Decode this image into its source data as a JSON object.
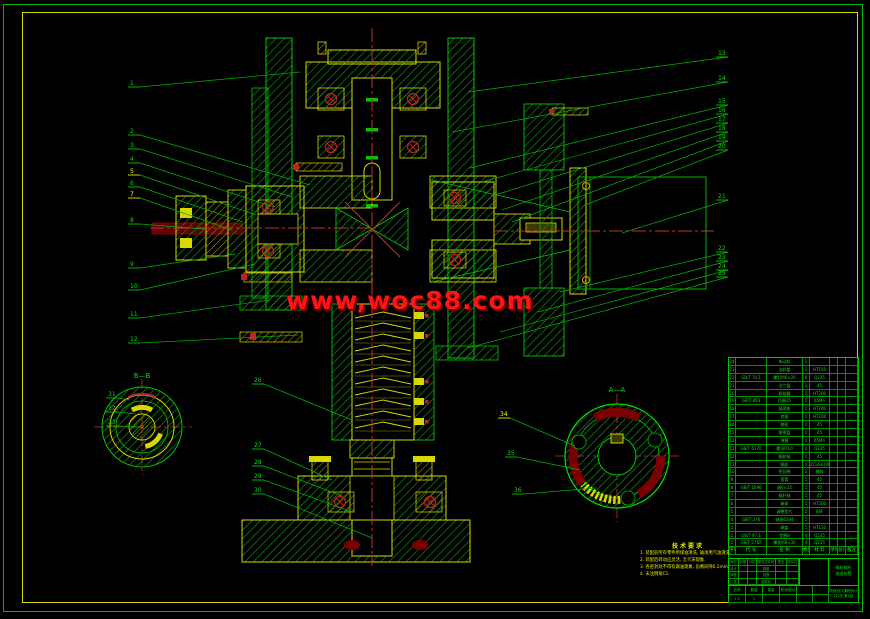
{
  "colors": {
    "green": "#00C800",
    "bright_green": "#00FF00",
    "yellow": "#D8D800",
    "red": "#FF1414",
    "dark_red": "#8B0000",
    "centerline_red": "#C23030",
    "hatch_green": "#128A12"
  },
  "watermark": {
    "text": "www,woc88.com"
  },
  "views": {
    "left_label": "B—B",
    "right_label": "A—A"
  },
  "notes": {
    "title": "技术要求",
    "lines": [
      "1. 装配前所有零件用煤油清洗, 轴承用汽油清洗.",
      "2. 装配后转动应灵活, 无卡滞现象.",
      "3. 各密封处不得有漏油现象, 齿侧间隙0.2mm.",
      "4. 未注倒角C1."
    ]
  },
  "callouts": [
    {
      "n": "1",
      "c": "g",
      "lx": 128,
      "ly": 85,
      "tx": 300,
      "ty": 72
    },
    {
      "n": "2",
      "c": "g",
      "lx": 128,
      "ly": 133,
      "tx": 310,
      "ty": 185
    },
    {
      "n": "3",
      "c": "g",
      "lx": 128,
      "ly": 147,
      "tx": 292,
      "ty": 197
    },
    {
      "n": "4",
      "c": "g",
      "lx": 128,
      "ly": 161,
      "tx": 274,
      "ty": 207
    },
    {
      "n": "5",
      "c": "y",
      "lx": 128,
      "ly": 173,
      "tx": 256,
      "ty": 215
    },
    {
      "n": "6",
      "c": "g",
      "lx": 128,
      "ly": 185,
      "tx": 243,
      "ty": 222
    },
    {
      "n": "7",
      "c": "y",
      "lx": 128,
      "ly": 196,
      "tx": 232,
      "ty": 230
    },
    {
      "n": "8",
      "c": "g",
      "lx": 128,
      "ly": 222,
      "tx": 204,
      "ty": 229
    },
    {
      "n": "9",
      "c": "g",
      "lx": 128,
      "ly": 266,
      "tx": 235,
      "ty": 254
    },
    {
      "n": "10",
      "c": "g",
      "lx": 128,
      "ly": 288,
      "tx": 255,
      "ty": 264
    },
    {
      "n": "11",
      "c": "g",
      "lx": 128,
      "ly": 316,
      "tx": 270,
      "ty": 300
    },
    {
      "n": "12",
      "c": "g",
      "lx": 128,
      "ly": 341,
      "tx": 298,
      "ty": 335
    },
    {
      "n": "13",
      "c": "g",
      "lx": 716,
      "ly": 55,
      "tx": 468,
      "ty": 92
    },
    {
      "n": "14",
      "c": "g",
      "lx": 716,
      "ly": 80,
      "tx": 452,
      "ty": 132
    },
    {
      "n": "15",
      "c": "g",
      "lx": 716,
      "ly": 103,
      "tx": 470,
      "ty": 168
    },
    {
      "n": "16",
      "c": "g",
      "lx": 716,
      "ly": 112,
      "tx": 482,
      "ty": 182
    },
    {
      "n": "17",
      "c": "g",
      "lx": 716,
      "ly": 121,
      "tx": 492,
      "ty": 196
    },
    {
      "n": "18",
      "c": "g",
      "lx": 716,
      "ly": 130,
      "tx": 502,
      "ty": 210
    },
    {
      "n": "19",
      "c": "g",
      "lx": 716,
      "ly": 139,
      "tx": 512,
      "ty": 222
    },
    {
      "n": "20",
      "c": "g",
      "lx": 716,
      "ly": 148,
      "tx": 585,
      "ty": 205
    },
    {
      "n": "21",
      "c": "g",
      "lx": 716,
      "ly": 198,
      "tx": 622,
      "ty": 233
    },
    {
      "n": "22",
      "c": "g",
      "lx": 716,
      "ly": 250,
      "tx": 560,
      "ty": 292
    },
    {
      "n": "23",
      "c": "g",
      "lx": 716,
      "ly": 259,
      "tx": 538,
      "ty": 312
    },
    {
      "n": "24",
      "c": "g",
      "lx": 716,
      "ly": 268,
      "tx": 500,
      "ty": 332
    },
    {
      "n": "25",
      "c": "g",
      "lx": 716,
      "ly": 275,
      "tx": 468,
      "ty": 348
    },
    {
      "n": "26",
      "c": "g",
      "lx": 252,
      "ly": 382,
      "tx": 352,
      "ty": 420
    },
    {
      "n": "27",
      "c": "g",
      "lx": 252,
      "ly": 447,
      "tx": 332,
      "ty": 480
    },
    {
      "n": "28",
      "c": "g",
      "lx": 252,
      "ly": 464,
      "tx": 342,
      "ty": 496
    },
    {
      "n": "29",
      "c": "g",
      "lx": 252,
      "ly": 478,
      "tx": 352,
      "ty": 512
    },
    {
      "n": "30",
      "c": "g",
      "lx": 252,
      "ly": 492,
      "tx": 372,
      "ty": 538
    },
    {
      "n": "31",
      "c": "g",
      "lx": 106,
      "ly": 396,
      "tx": 130,
      "ty": 400
    },
    {
      "n": "32",
      "c": "g",
      "lx": 106,
      "ly": 410,
      "tx": 136,
      "ty": 414
    },
    {
      "n": "33",
      "c": "g",
      "lx": 106,
      "ly": 424,
      "tx": 141,
      "ty": 427
    },
    {
      "n": "34",
      "c": "y",
      "lx": 498,
      "ly": 416,
      "tx": 575,
      "ty": 446
    },
    {
      "n": "35",
      "c": "g",
      "lx": 505,
      "ly": 455,
      "tx": 580,
      "ty": 470
    },
    {
      "n": "36",
      "c": "g",
      "lx": 512,
      "ly": 492,
      "tx": 596,
      "ty": 488
    }
  ],
  "bom": {
    "headers": [
      "序号",
      "代  号",
      "名  称",
      "数量",
      "材 料",
      "单件",
      "总计",
      "备注"
    ],
    "weight_label": "重 量",
    "rows": [
      [
        "24",
        "",
        "电动机",
        "1",
        "",
        "",
        "",
        ""
      ],
      [
        "23",
        "",
        "油封盖",
        "1",
        "HT150",
        "",
        "",
        ""
      ],
      [
        "22",
        "GB/T 70.1",
        "螺钉M6×20",
        "6",
        "Q235",
        "",
        "",
        ""
      ],
      [
        "21",
        "",
        "法兰盘",
        "1",
        "45",
        "",
        "",
        ""
      ],
      [
        "20",
        "",
        "联轴器",
        "1",
        "HT200",
        "",
        "",
        ""
      ],
      [
        "19",
        "GB/T 893",
        "挡圈35",
        "1",
        "65Mn",
        "",
        "",
        ""
      ],
      [
        "18",
        "",
        "轴承座",
        "1",
        "HT200",
        "",
        "",
        ""
      ],
      [
        "17",
        "",
        "底座",
        "1",
        "HT200",
        "",
        "",
        ""
      ],
      [
        "16",
        "",
        "棘轮",
        "1",
        "45",
        "",
        "",
        ""
      ],
      [
        "15",
        "",
        "摩擦盘",
        "1",
        "45",
        "",
        "",
        ""
      ],
      [
        "14",
        "",
        "弹簧",
        "1",
        "65Mn",
        "",
        "",
        ""
      ],
      [
        "13",
        "GB/T 6170",
        "螺母M10",
        "2",
        "Q235",
        "",
        "",
        ""
      ],
      [
        "12",
        "",
        "蜗轮轴",
        "1",
        "45",
        "",
        "",
        ""
      ],
      [
        "11",
        "",
        "蜗轮",
        "1",
        "ZCuSn10P1",
        "",
        "",
        ""
      ],
      [
        "10",
        "",
        "密封圈",
        "2",
        "橡胶",
        "",
        "",
        ""
      ],
      [
        "9",
        "",
        "套筒",
        "1",
        "45",
        "",
        "",
        ""
      ],
      [
        "8",
        "GB/T 1096",
        "键6×25",
        "1",
        "45",
        "",
        "",
        ""
      ],
      [
        "7",
        "",
        "蜗杆轴",
        "1",
        "45",
        "",
        "",
        ""
      ],
      [
        "6",
        "",
        "箱体",
        "1",
        "HT200",
        "",
        "",
        ""
      ],
      [
        "5",
        "",
        "调整垫片",
        "2",
        "08F",
        "",
        "",
        ""
      ],
      [
        "4",
        "GB/T 276",
        "轴承6204",
        "2",
        "",
        "",
        "",
        ""
      ],
      [
        "3",
        "",
        "端盖",
        "1",
        "HT150",
        "",
        "",
        ""
      ],
      [
        "2",
        "GB/T 97.1",
        "垫圈8",
        "4",
        "Q235",
        "",
        "",
        ""
      ],
      [
        "1",
        "GB/T 5782",
        "螺栓M8×30",
        "4",
        "Q235",
        "",
        "",
        ""
      ]
    ]
  },
  "title_block": {
    "grid": [
      "标记",
      "处数",
      "分区",
      "更改文件号",
      "签名",
      "年月日",
      "设计",
      "",
      "",
      "校核",
      "",
      "",
      "审核",
      "",
      "",
      "批准",
      "",
      "",
      "工艺",
      "",
      "",
      "标准化",
      "",
      ""
    ],
    "name_line1": "蜗轮蜗杆",
    "name_line2": "减速装置",
    "bot_cells": [
      "比例",
      "数量",
      "重量",
      "阶段标记",
      "",
      ""
    ],
    "bot_cells2": [
      "1:2",
      "1",
      "",
      "",
      "",
      ""
    ],
    "org_line1": "机械设计课程设计",
    "sheet": "共1张 第1张"
  }
}
